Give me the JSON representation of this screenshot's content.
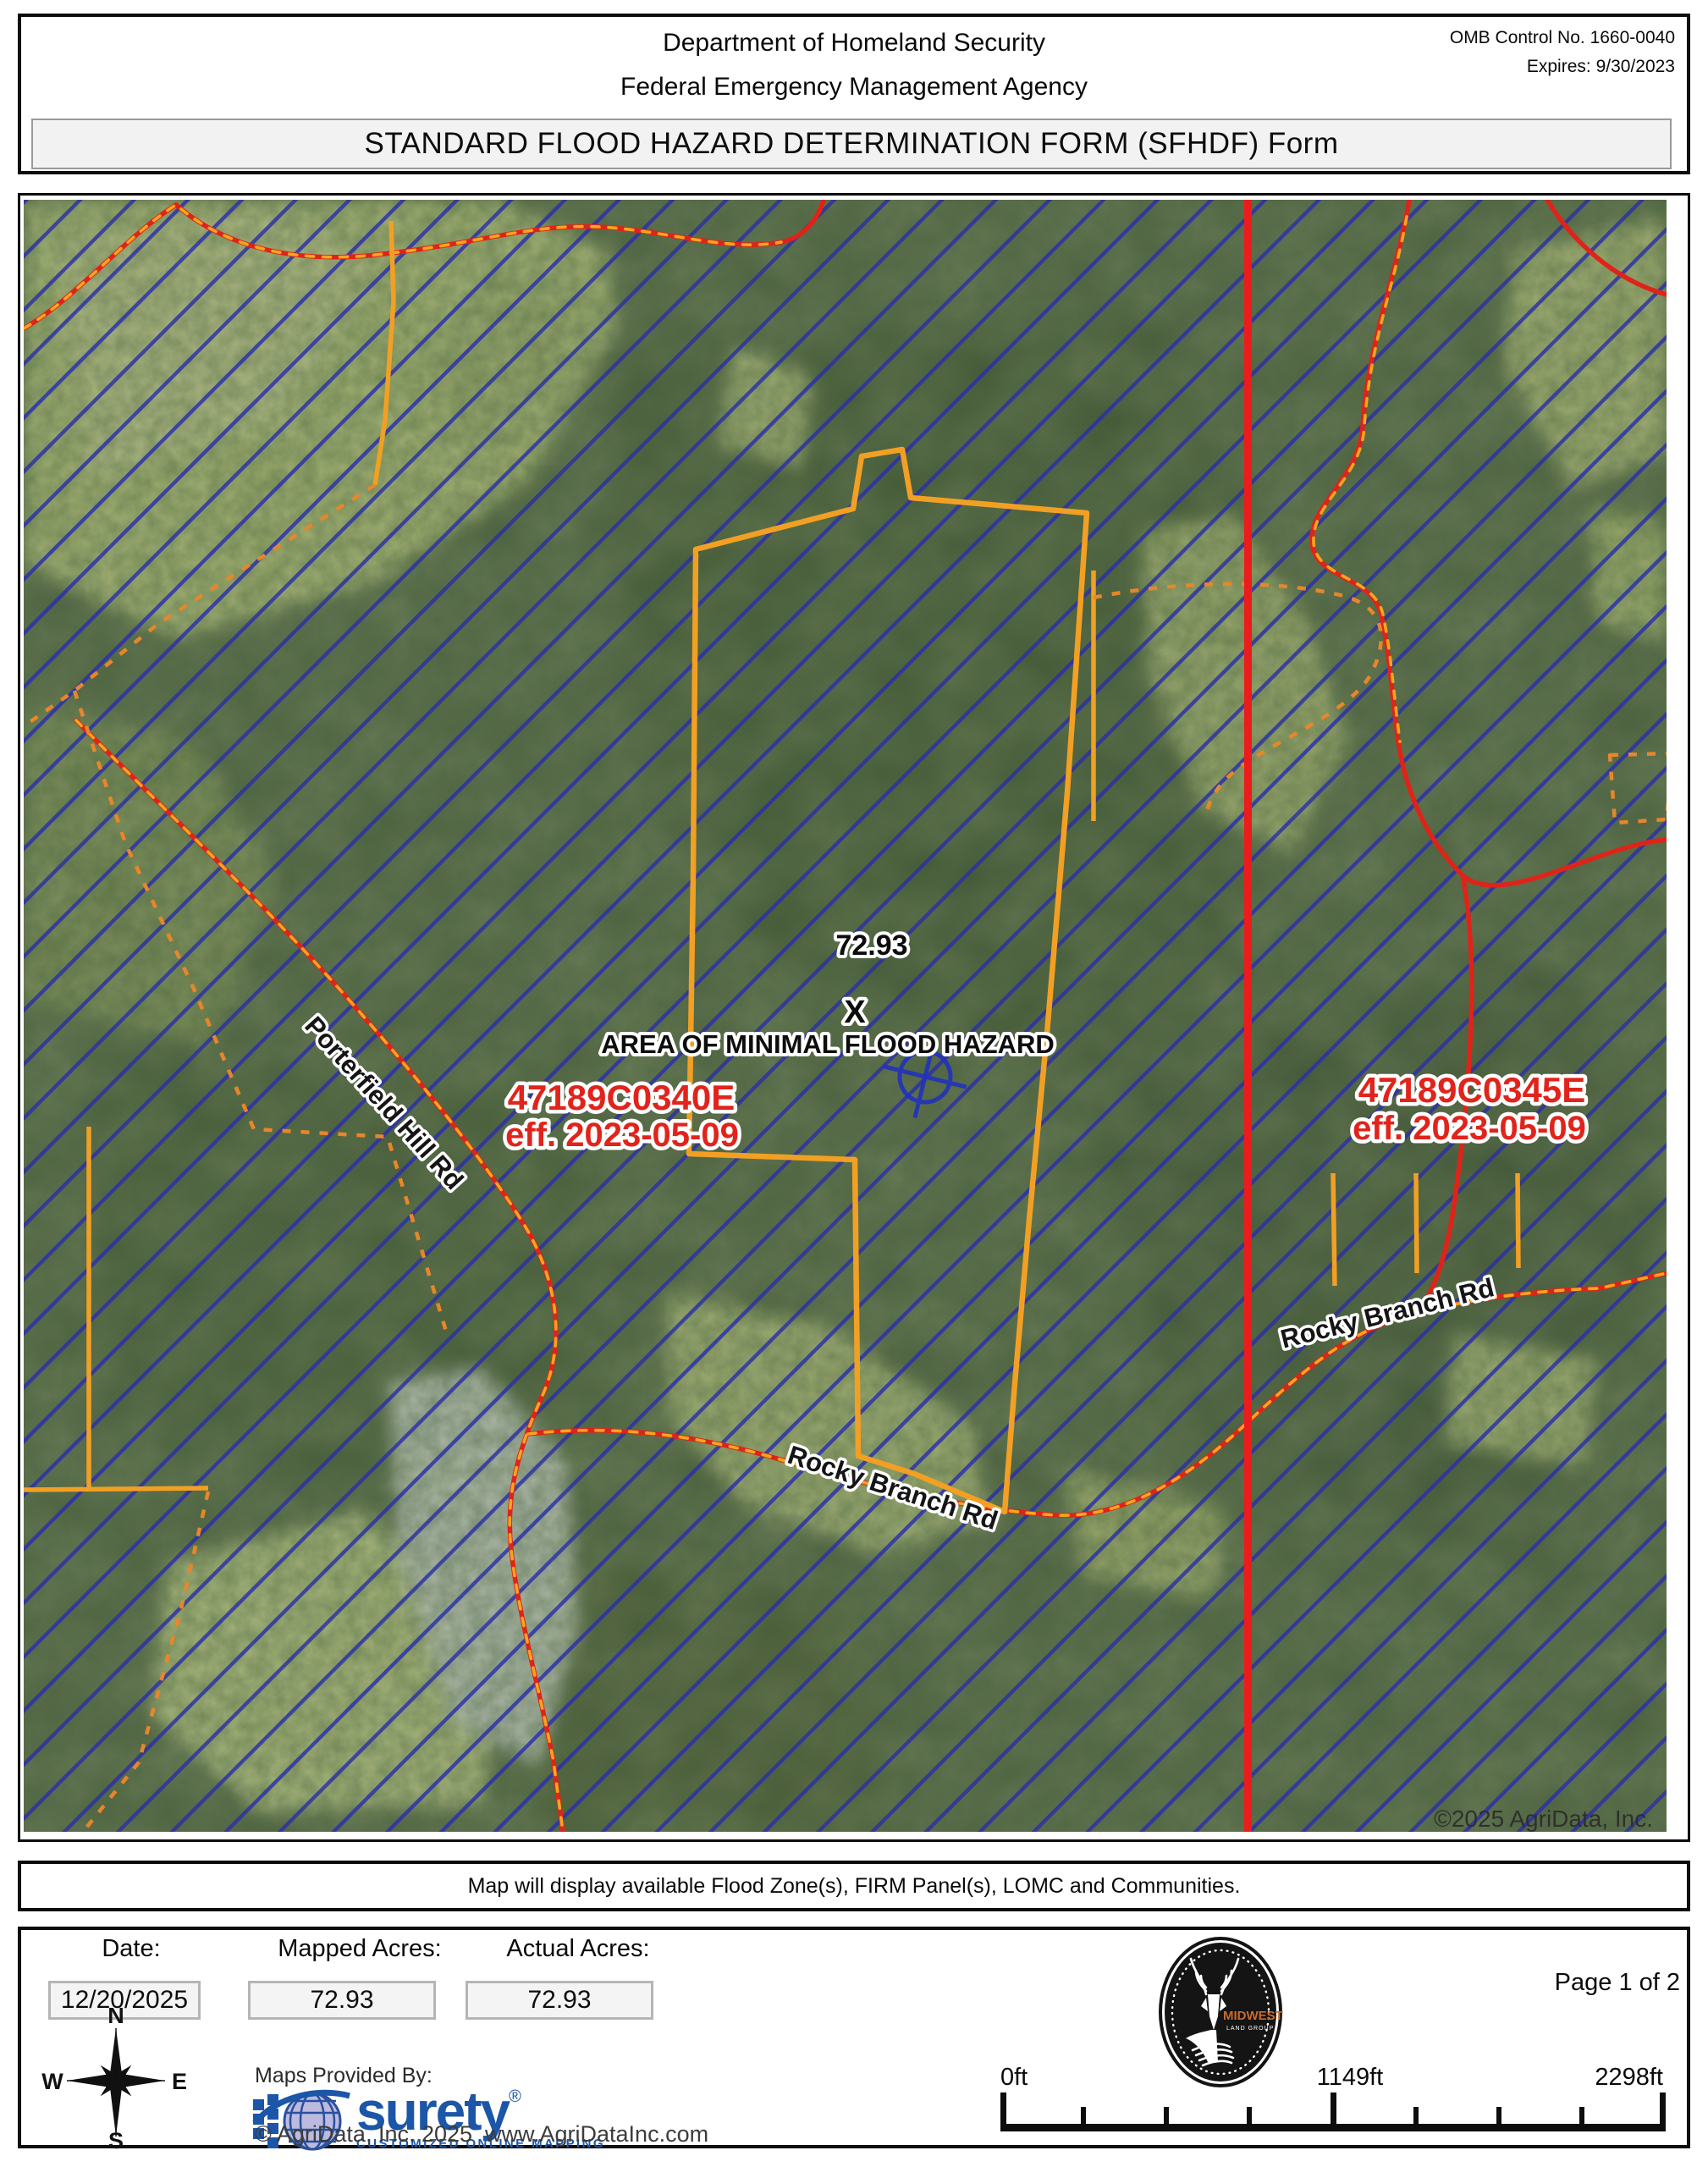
{
  "header": {
    "agency_line1": "Department of Homeland Security",
    "agency_line2": "Federal Emergency Management Agency",
    "omb_control": "OMB Control No. 1660-0040",
    "expires": "Expires: 9/30/2023",
    "title": "STANDARD FLOOD HAZARD DETERMINATION FORM (SFHDF) Form"
  },
  "map": {
    "acres_label": "72.93",
    "zone_marker": "X",
    "zone_label": "AREA OF MINIMAL FLOOD HAZARD",
    "firm_panels": [
      {
        "id": "47189C0340E",
        "eff": "eff. 2023-05-09"
      },
      {
        "id": "47189C0345E",
        "eff": "eff. 2023-05-09"
      }
    ],
    "road_labels": [
      "Porterfield Hill Rd",
      "Rocky Branch Rd",
      "Rocky Branch Rd"
    ],
    "copyright": "©2025 AgriData, Inc.",
    "colors": {
      "flood_hatch_blue": "#2b2fa8",
      "parcel_orange": "#f2a024",
      "road_red": "#e02318",
      "firm_line_red": "#ec1c1c",
      "panel_label_red": "#e0241c"
    }
  },
  "notice": "Map will display available Flood Zone(s), FIRM Panel(s), LOMC and Communities.",
  "footer": {
    "date_label": "Date:",
    "date_value": "12/20/2025",
    "mapped_acres_label": "Mapped Acres:",
    "mapped_acres_value": "72.93",
    "actual_acres_label": "Actual Acres:",
    "actual_acres_value": "72.93",
    "page_indicator": "Page 1 of 2",
    "maps_provided_by": "Maps Provided By:",
    "surety": {
      "name": "surety",
      "reg": "®",
      "tagline": "CUSTOMIZED ONLINE MAPPING"
    },
    "copyright": "© AgriData, Inc. 2025",
    "website": "www.AgriDataInc.com",
    "deer_badge": {
      "brand": "MIDWEST",
      "sub": "LAND GROUP"
    },
    "compass": {
      "n": "N",
      "s": "S",
      "e": "E",
      "w": "W"
    },
    "scale": {
      "start": "0ft",
      "mid": "1149ft",
      "end": "2298ft"
    }
  }
}
